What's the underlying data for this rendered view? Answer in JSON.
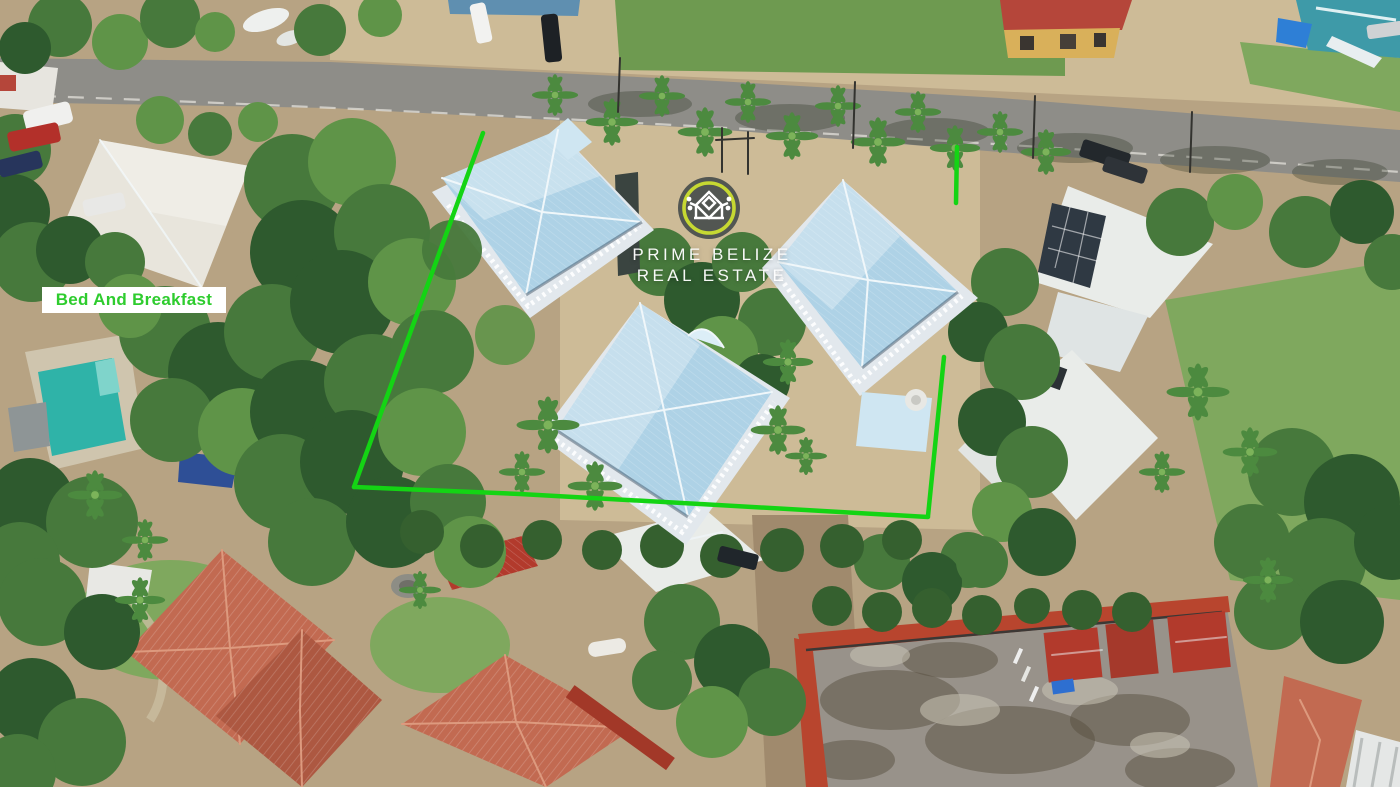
{
  "page": {
    "type": "aerial-drone-photograph",
    "width": 1400,
    "height": 787
  },
  "watermark": {
    "line1": "PRIME BELIZE",
    "line2": "REAL ESTATE",
    "logo_icon": "mayan-temple-emblem",
    "ring_color": "#c6d832",
    "badge_color": "#484d4c",
    "emblem_color": "#ffffff",
    "text_color": "#ffffff"
  },
  "label": {
    "text": "Bed And Breakfast",
    "text_color": "#2ecc2e",
    "background": "#ffffff"
  },
  "boundary": {
    "color": "#14d414"
  },
  "palette": {
    "sand": "#b7a383",
    "sand_light": "#cdbb97",
    "sand_dark": "#a08a6d",
    "road": "#8e8d88",
    "road_line": "#e8e6e0",
    "grass": "#6e9a50",
    "lawn": "#7fa85e",
    "roof_blue": "#aed2e6",
    "roof_blue_light": "#cfe6f2",
    "roof_white": "#e9ece9",
    "roof_bnb": "#e8e5dc",
    "veranda": "#e2e8ed",
    "terracotta": "#c26a51",
    "terracotta_dark": "#ad5841",
    "red_metal": "#b23a2c",
    "red_tile_edge": "#b8452e",
    "construction": "#98928a",
    "pool": "#2fb3a8",
    "pool_deck": "#cfc5ae",
    "tarp_blue": "#2e4f96",
    "solar": "#2f3943",
    "teal_house": "#3e9aa8"
  }
}
